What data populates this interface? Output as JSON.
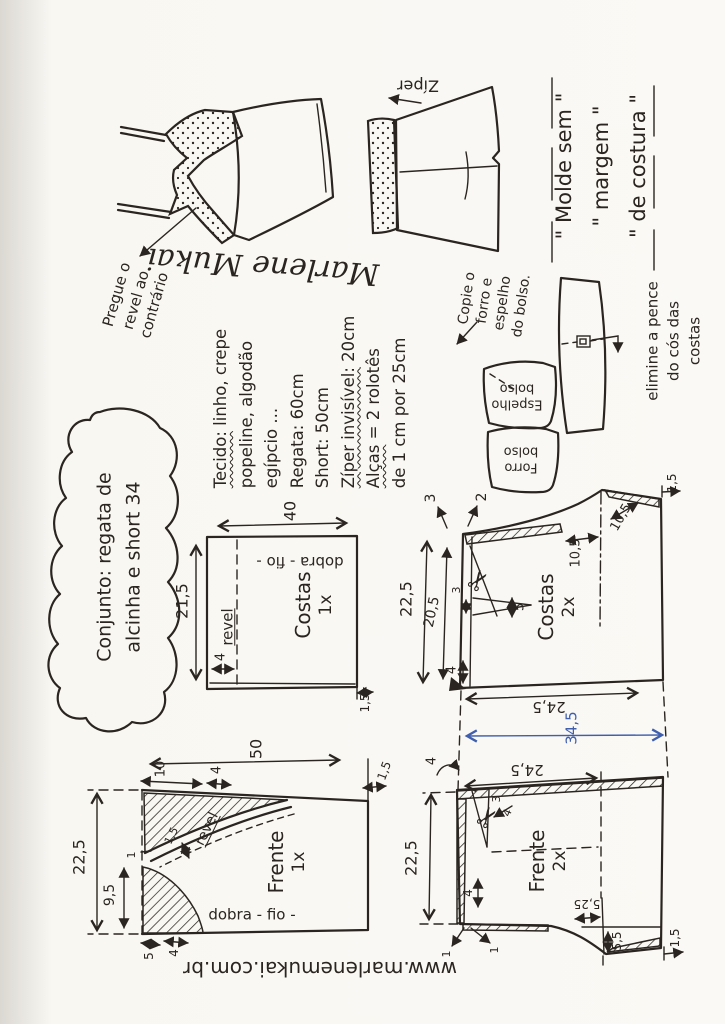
{
  "colors": {
    "ink": "#2a2520",
    "blue_ink": "#3f5fae",
    "paper": "#f9f7f2"
  },
  "footer": {
    "site": "www.marlenemukai.com.br"
  },
  "bubble": {
    "l1": "Conjunto: regata de",
    "l2": "alcinha e short  34"
  },
  "sketch": {
    "pregue_l1": "Pregue o",
    "pregue_l2": "revel ao",
    "pregue_l3": "contrário",
    "signature": "Marlene Mukai",
    "ziper": "Zíper",
    "molde_l1": "\" Molde sem \"",
    "molde_l2": "\" margem \"",
    "molde_l3": "\" de costura \"",
    "cos_l1": "elimine a pence",
    "cos_l2": "do cós das",
    "cos_l3": "costas",
    "pocket_l1": "Copie o",
    "pocket_l2": "forro e",
    "pocket_l3": "espelho",
    "pocket_l4": "do bolso.",
    "espelho_l1": "Espelho",
    "espelho_l2": "bolso",
    "forro_l1": "Forro",
    "forro_l2": "bolso",
    "scissors": "✂"
  },
  "materials": {
    "l1a": "Tecido:",
    "l1b": " linho, crepe",
    "l2": "popeline, algodão",
    "l3": "egípcio ...",
    "l4": "Regata: 60cm",
    "l5": "Short: 50cm",
    "l6a": "Zíper invisível:",
    "l6b": " 20cm",
    "l7a": "Alças",
    "l7b": " = 2 rolotês",
    "l8": "de 1 cm por 25cm"
  },
  "costas_regata": {
    "label": "Costas",
    "qty": "1x",
    "fold": "dobra - fio -",
    "revel": "revel",
    "w": "40",
    "h": "21,5",
    "revel_w": "4",
    "hem": "1,5"
  },
  "costas_short": {
    "label": "Costas",
    "qty": "2x",
    "h": "22,5",
    "h_inner": "20,5",
    "up1": "3",
    "up2": "2",
    "dart_w": "3",
    "dart_d": "5",
    "leg": "4",
    "crotch_a": "10,5",
    "crotch_b": "10,5",
    "hem": "1,5",
    "waist": "24,5"
  },
  "frente_regata": {
    "label": "Frente",
    "qty": "1x",
    "fold": "dobra - fio -",
    "revel": "revel",
    "w": "50",
    "h": "22,5",
    "shoulder": "10",
    "strap": "4",
    "revel_w": "1,5",
    "notch": "1",
    "neck": "9,5",
    "b1": "5",
    "b2": "4",
    "hem": "1,5"
  },
  "frente_short": {
    "label": "Frente",
    "qty": "2x",
    "h": "22,5",
    "waist": "24,5",
    "ease": "4",
    "dart_a": "3",
    "dart_b": "4",
    "leg": "4",
    "one_a": "1",
    "one_b": "1",
    "hem_w": "5,25",
    "hem_h": "5,5",
    "hem": "1,5"
  },
  "shared": {
    "total": "34,5"
  }
}
